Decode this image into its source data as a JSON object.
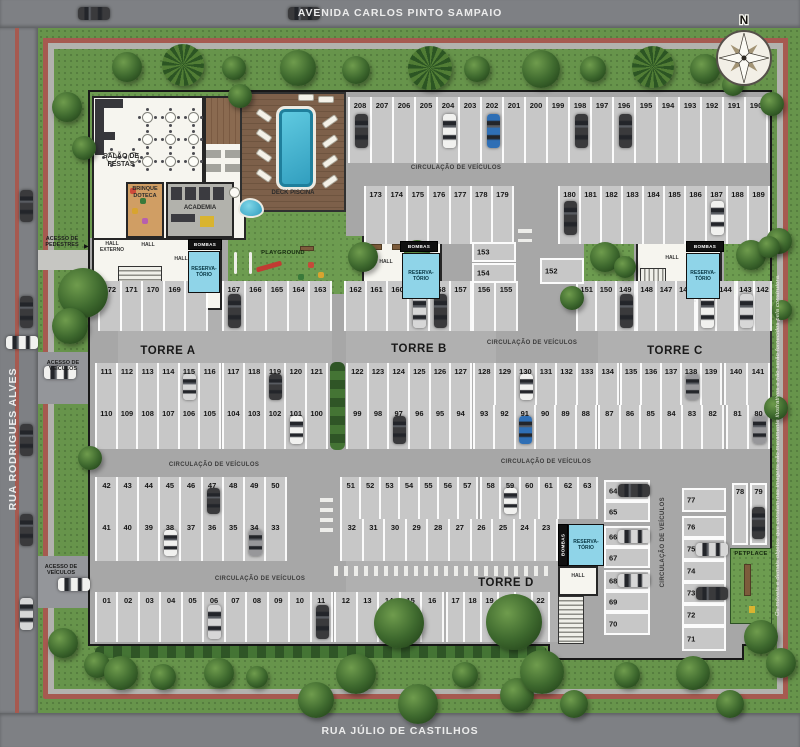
{
  "streets": {
    "top": "AVENIDA CARLOS PINTO SAMPAIO",
    "left": "RUA RODRIGUES ALVES",
    "bottom": "RUA JÚLIO DE CASTILHOS"
  },
  "compass": {
    "north_label": "N"
  },
  "disclaimer": "Os móveis e demais objetos que constam nas imagens são meramente ilustrativos e não serão fornecidos pela construtora.",
  "towers": {
    "a": "TORRE A",
    "b": "TORRE B",
    "c": "TORRE C",
    "d": "TORRE D"
  },
  "signs": {
    "circulacao": "CIRCULAÇÃO DE VEÍCULOS",
    "acesso_pedestres": "ACESSO DE PEDESTRES",
    "acesso_veiculos": "ACESSO DE VEÍCULOS"
  },
  "areas": {
    "salao_de_festas": "SALÃO DE FESTAS",
    "brinquedoteca": "BRINQUE DOTECA",
    "academia": "ACADEMIA",
    "deck_piscina": "DECK PISCINA",
    "playground": "PLAYGROUND",
    "petplace": "PETPLACE",
    "hall_externo": "HALL EXTERNO",
    "hall": "HALL",
    "bombas": "BOMBAS",
    "reservatorio": "RESERVA-TÓRIO"
  },
  "parking": {
    "rows": [
      {
        "id": "r1",
        "stalls": [
          "208",
          "207",
          "206",
          "205",
          "204",
          "203",
          "202",
          "201",
          "200",
          "199",
          "198",
          "197",
          "196",
          "195",
          "194",
          "193",
          "192",
          "191",
          "190"
        ],
        "cars": {
          "208": "dark",
          "204": "white",
          "202": "blue",
          "198": "dark",
          "196": "dark"
        }
      },
      {
        "id": "r2a",
        "stalls": [
          "173",
          "174",
          "175",
          "176",
          "177",
          "178",
          "179"
        ],
        "cars": {}
      },
      {
        "id": "r2b",
        "stalls": [
          "180",
          "181",
          "182",
          "183",
          "184",
          "185",
          "186",
          "187",
          "188",
          "189"
        ],
        "cars": {
          "180": "dark",
          "187": "white"
        }
      },
      {
        "id": "r3a",
        "stalls": [
          "172",
          "171",
          "170",
          "169",
          "168"
        ],
        "cars": {}
      },
      {
        "id": "r3b",
        "stalls": [
          "167",
          "166",
          "165",
          "164",
          "163"
        ],
        "cars": {
          "167": "dark"
        }
      },
      {
        "id": "r3c",
        "stalls": [
          "162",
          "161",
          "160",
          "159",
          "158",
          "157"
        ],
        "cars": {
          "159": "silver",
          "158": "dark"
        }
      },
      {
        "id": "r3d",
        "stalls": [
          "156",
          "155"
        ],
        "cars": {}
      },
      {
        "id": "r3e",
        "stalls": [
          "151",
          "150",
          "149"
        ],
        "cars": {
          "149": "dark"
        }
      },
      {
        "id": "r3f",
        "stalls": [
          "148",
          "147",
          "146"
        ],
        "cars": {}
      },
      {
        "id": "r3g",
        "stalls": [
          "145",
          "144"
        ],
        "cars": {
          "145": "white"
        }
      },
      {
        "id": "r3h",
        "stalls": [
          "143",
          "142"
        ],
        "cars": {
          "143": "silver"
        }
      },
      {
        "id": "r4a",
        "stalls": [
          "111",
          "112",
          "113",
          "114",
          "115",
          "116"
        ],
        "cars": {
          "115": "silver"
        }
      },
      {
        "id": "r4b",
        "stalls": [
          "117",
          "118",
          "119",
          "120",
          "121"
        ],
        "cars": {
          "119": "dark"
        }
      },
      {
        "id": "r4c",
        "stalls": [
          "122",
          "123",
          "124",
          "125",
          "126",
          "127"
        ],
        "cars": {}
      },
      {
        "id": "r4d",
        "stalls": [
          "128",
          "129",
          "130",
          "131",
          "132",
          "133",
          "134"
        ],
        "cars": {
          "130": "white"
        }
      },
      {
        "id": "r4e",
        "stalls": [
          "135",
          "136",
          "137",
          "138",
          "139"
        ],
        "cars": {
          "138": "gray"
        }
      },
      {
        "id": "r4f",
        "stalls": [
          "140",
          "141"
        ],
        "cars": {}
      },
      {
        "id": "r5a",
        "stalls": [
          "110",
          "109",
          "108",
          "107",
          "106",
          "105"
        ],
        "cars": {}
      },
      {
        "id": "r5b",
        "stalls": [
          "104",
          "103",
          "102",
          "101",
          "100"
        ],
        "cars": {
          "101": "white"
        }
      },
      {
        "id": "r5c",
        "stalls": [
          "99",
          "98",
          "97",
          "96",
          "95",
          "94"
        ],
        "cars": {
          "97": "dark"
        }
      },
      {
        "id": "r5d",
        "stalls": [
          "93",
          "92",
          "91",
          "90",
          "89",
          "88"
        ],
        "cars": {
          "91": "blue"
        }
      },
      {
        "id": "r5e",
        "stalls": [
          "87",
          "86",
          "85",
          "84",
          "83",
          "82"
        ],
        "cars": {}
      },
      {
        "id": "r5f",
        "stalls": [
          "81",
          "80"
        ],
        "cars": {
          "80": "gray"
        }
      },
      {
        "id": "r6a",
        "stalls": [
          "42",
          "43",
          "44",
          "45",
          "46",
          "47",
          "48",
          "49",
          "50"
        ],
        "cars": {
          "47": "dark"
        }
      },
      {
        "id": "r6b",
        "stalls": [
          "51",
          "52",
          "53",
          "54",
          "55",
          "56",
          "57"
        ],
        "cars": {}
      },
      {
        "id": "r6c",
        "stalls": [
          "58",
          "59",
          "60",
          "61",
          "62",
          "63"
        ],
        "cars": {
          "59": "white"
        }
      },
      {
        "id": "r7a",
        "stalls": [
          "41",
          "40",
          "39",
          "38",
          "37",
          "36",
          "35",
          "34",
          "33"
        ],
        "cars": {
          "38": "white",
          "34": "gray"
        }
      },
      {
        "id": "r7b",
        "stalls": [
          "32",
          "31",
          "30",
          "29",
          "28",
          "27",
          "26",
          "25",
          "24",
          "23"
        ],
        "cars": {}
      },
      {
        "id": "r8a",
        "stalls": [
          "01",
          "02",
          "03",
          "04",
          "05",
          "06",
          "07",
          "08",
          "09",
          "10",
          "11"
        ],
        "cars": {
          "06": "silver",
          "11": "dark"
        }
      },
      {
        "id": "r8b",
        "stalls": [
          "12",
          "13",
          "14",
          "15",
          "16"
        ],
        "cars": {}
      },
      {
        "id": "r8c",
        "stalls": [
          "17",
          "18",
          "19",
          "20",
          "21",
          "22"
        ],
        "cars": {}
      }
    ],
    "singles": [
      {
        "id": "s153",
        "num": "153"
      },
      {
        "id": "s154",
        "num": "154"
      },
      {
        "id": "s152",
        "num": "152"
      },
      {
        "id": "s64",
        "num": "64",
        "car": "dark"
      },
      {
        "id": "s65",
        "num": "65"
      },
      {
        "id": "s66",
        "num": "66",
        "car": "silver"
      },
      {
        "id": "s67",
        "num": "67"
      },
      {
        "id": "s68",
        "num": "68",
        "car": "silver"
      },
      {
        "id": "s69",
        "num": "69"
      },
      {
        "id": "s70",
        "num": "70"
      },
      {
        "id": "s77",
        "num": "77"
      },
      {
        "id": "s76",
        "num": "76"
      },
      {
        "id": "s75",
        "num": "75",
        "car": "silver"
      },
      {
        "id": "s74",
        "num": "74"
      },
      {
        "id": "s73",
        "num": "73",
        "car": "dark"
      },
      {
        "id": "s72",
        "num": "72"
      },
      {
        "id": "s71",
        "num": "71"
      },
      {
        "id": "s78",
        "num": "78"
      },
      {
        "id": "s79",
        "num": "79",
        "car": "dark"
      }
    ]
  },
  "colors": {
    "cars": {
      "dark": "#3a3a3c",
      "silver": "#d7d7d7",
      "white": "#f1f1ef",
      "blue": "#2f6fb5",
      "gray": "#97979a"
    },
    "reservoir": "#8fd4e8",
    "path": "#a65a50",
    "pool": "#2f9cbd"
  }
}
